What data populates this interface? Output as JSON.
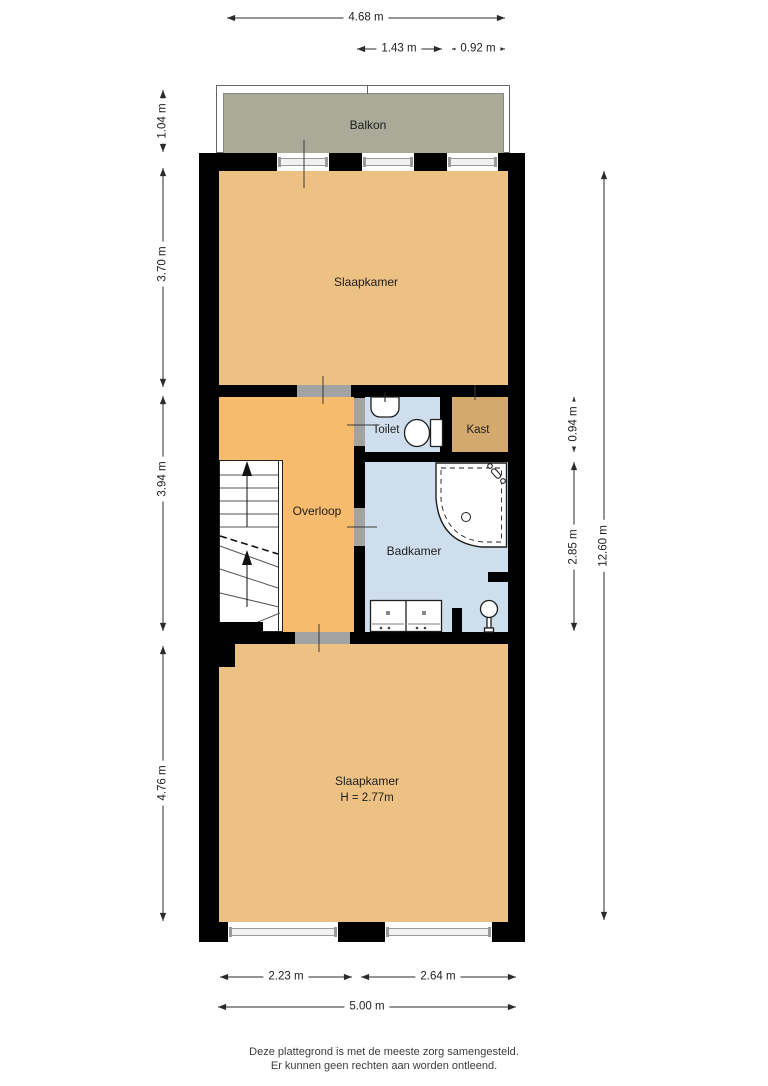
{
  "rooms": {
    "balkon": {
      "label": "Balkon"
    },
    "slaapkamer_boven": {
      "label": "Slaapkamer"
    },
    "toilet": {
      "label": "Toilet"
    },
    "kast": {
      "label": "Kast"
    },
    "overloop": {
      "label": "Overloop"
    },
    "badkamer": {
      "label": "Badkamer"
    },
    "slaapkamer_beneden": {
      "label": "Slaapkamer",
      "height": "H = 2.77m"
    }
  },
  "dimensions": {
    "top": {
      "total": "4.68 m",
      "segment_door": "1.43 m",
      "segment_window": "0.92 m"
    },
    "left": {
      "balkon": "1.04 m",
      "slaapkamer_boven": "3.70 m",
      "middenzone": "3.94 m",
      "slaapkamer_beneden": "4.76 m"
    },
    "right": {
      "toilet": "0.94 m",
      "badkamer": "2.85 m",
      "total": "12.60 m"
    },
    "bottom": {
      "left_deel": "2.23 m",
      "right_deel": "2.64 m",
      "total": "5.00 m"
    }
  },
  "disclaimer": {
    "line1": "Deze plattegrond is met de meeste zorg samengesteld.",
    "line2": "Er kunnen geen rechten aan worden ontleend."
  },
  "colors": {
    "wall": "#000000",
    "room_orange": "#ecc183",
    "hall_orange": "#f6bb6c",
    "closet_tan": "#d3a96e",
    "wet_blue": "#cfdeed",
    "balcony_green": "#a9aa97",
    "opening_gray": "#a3a3a3"
  }
}
